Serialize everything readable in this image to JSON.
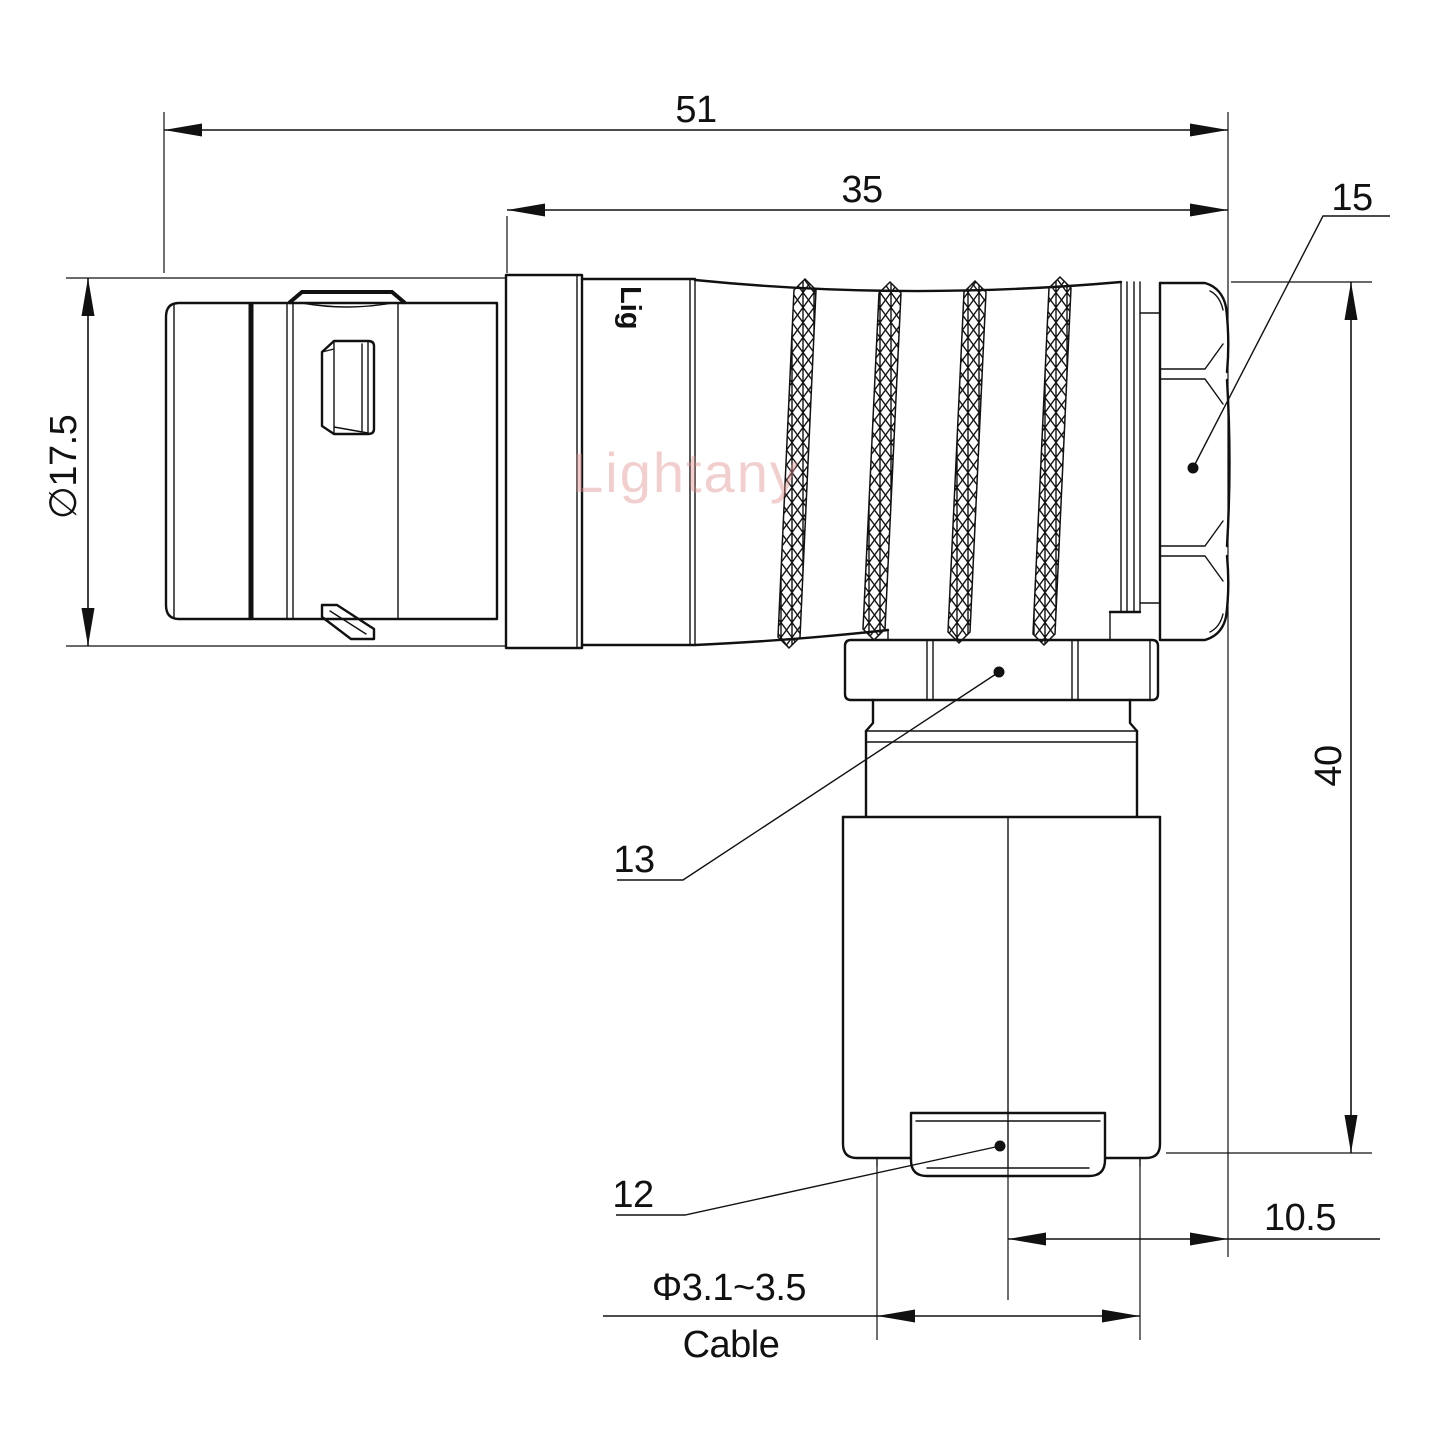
{
  "drawing": {
    "type": "engineering-dimension-drawing",
    "subject": "right-angle elbow push-pull circular connector, side view",
    "colors": {
      "line": "#111111",
      "watermark": "#e08f8f",
      "background": "#ffffff"
    },
    "watermark": {
      "text": "Lightany"
    },
    "engraving": {
      "text": "Lig"
    },
    "labels": {
      "overall_length": "51",
      "grip_length": "35",
      "backnut_ref": "15",
      "front_diameter": "∅17.5",
      "height": "40",
      "coupling_nut_ref": "13",
      "cap_ref": "12",
      "axis_offset": "10.5",
      "cable_range": "Φ3.1~3.5",
      "cable_word": "Cable"
    }
  }
}
